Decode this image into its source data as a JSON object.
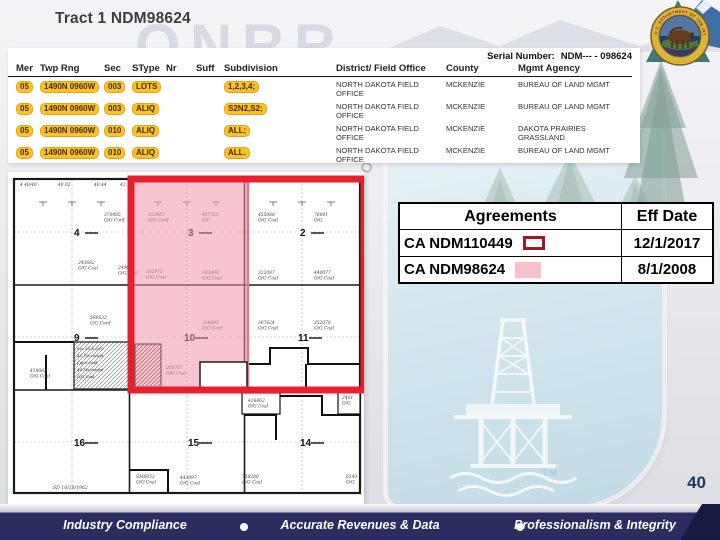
{
  "title": "Tract 1 NDM98624",
  "page_number": "40",
  "serial": {
    "label": "Serial Number:",
    "value": "NDM--- - 098624"
  },
  "lease_table": {
    "headers": [
      "Mer",
      "Twp Rng",
      "Sec",
      "SType",
      "Nr",
      "Suff",
      "Subdivision",
      "District/ Field Office",
      "County",
      "Mgmt Agency"
    ],
    "highlight_color": "#FFC125",
    "rows": [
      {
        "mer": "05",
        "twp_rng": "1490N 0960W",
        "sec": "003",
        "stype": "LOTS",
        "nr": "",
        "suff": "",
        "subdivision": "1,2,3,4;",
        "district": "NORTH DAKOTA FIELD OFFICE",
        "county": "MCKENZIE",
        "agency": "BUREAU OF LAND MGMT"
      },
      {
        "mer": "05",
        "twp_rng": "1490N 0960W",
        "sec": "003",
        "stype": "ALIQ",
        "nr": "",
        "suff": "",
        "subdivision": "S2N2,S2;",
        "district": "NORTH DAKOTA FIELD OFFICE",
        "county": "MCKENZIE",
        "agency": "BUREAU OF LAND MGMT"
      },
      {
        "mer": "05",
        "twp_rng": "1490N 0960W",
        "sec": "010",
        "stype": "ALIQ",
        "nr": "",
        "suff": "",
        "subdivision": "ALL;",
        "district": "NORTH DAKOTA FIELD OFFICE",
        "county": "MCKENZIE",
        "agency": "DAKOTA PRAIRIES GRASSLAND"
      },
      {
        "mer": "05",
        "twp_rng": "1490N 0960W",
        "sec": "010",
        "stype": "ALIQ",
        "nr": "",
        "suff": "",
        "subdivision": "ALL.",
        "district": "NORTH DAKOTA FIELD OFFICE",
        "county": "MCKENZIE",
        "agency": "BUREAU OF LAND MGMT"
      }
    ]
  },
  "agreements_table": {
    "headers": [
      "Agreements",
      "Eff Date"
    ],
    "rows": [
      {
        "agreement": "CA NDM110449",
        "eff_date": "12/1/2017",
        "swatch": "red-outline"
      },
      {
        "agreement": "CA NDM98624",
        "eff_date": "8/1/2008",
        "swatch": "pink-fill"
      }
    ],
    "swatch_colors": {
      "red_outline_border": "#9E1B25",
      "pink_fill": "#F8C0CD"
    }
  },
  "map": {
    "overlay_colors": {
      "red_outline": "#E8202C",
      "pink_fill": "rgba(240,150,172,0.55)",
      "pink_border": "#E0768F"
    },
    "section_numbers": [
      "4",
      "3",
      "2",
      "9",
      "10",
      "11",
      "16",
      "15",
      "14"
    ],
    "top_acreage_labels": [
      "4 40/40",
      "40.02",
      "40.44",
      "41.11"
    ],
    "lease_labels": [
      {
        "x": 96,
        "y": 44,
        "n": "370485",
        "c": "O/G Conf"
      },
      {
        "x": 70,
        "y": 92,
        "n": "243682",
        "c": "O/G Coal"
      },
      {
        "x": 110,
        "y": 97,
        "n": "249072",
        "c": "O/G Coal"
      },
      {
        "x": 82,
        "y": 147,
        "n": "599532",
        "c": "O/G Conf"
      },
      {
        "x": 140,
        "y": 44,
        "n": "153957",
        "c": "O/G Conf"
      },
      {
        "x": 194,
        "y": 44,
        "n": "457751",
        "c": "O/C"
      },
      {
        "x": 138,
        "y": 101,
        "n": "302975",
        "c": "O/G Coal"
      },
      {
        "x": 194,
        "y": 102,
        "n": "303480",
        "c": "O/G Coal"
      },
      {
        "x": 250,
        "y": 44,
        "n": "455088",
        "c": "O/G Coal"
      },
      {
        "x": 306,
        "y": 44,
        "n": "76041",
        "c": "O/G"
      },
      {
        "x": 250,
        "y": 102,
        "n": "322087",
        "c": "O/G Coal"
      },
      {
        "x": 306,
        "y": 102,
        "n": "440077",
        "c": "O/G Coal"
      },
      {
        "x": 194,
        "y": 152,
        "n": "330495",
        "c": "O/G Conf"
      },
      {
        "x": 250,
        "y": 152,
        "n": "307624",
        "c": "O/G Coal"
      },
      {
        "x": 306,
        "y": 152,
        "n": "352078",
        "c": "O/G Coal"
      },
      {
        "x": 158,
        "y": 197,
        "n": "200787",
        "c": "O/G Coal"
      },
      {
        "x": 240,
        "y": 230,
        "n": "416462",
        "c": "O/G Coal"
      },
      {
        "x": 334,
        "y": 227,
        "n": "2401",
        "c": "O/G"
      },
      {
        "x": 22,
        "y": 200,
        "n": "419062",
        "c": "O/G Coal"
      },
      {
        "x": 128,
        "y": 306,
        "n": "SM6053",
        "c": "O/G Coal"
      },
      {
        "x": 172,
        "y": 307,
        "n": "443097",
        "c": "O/G Coal"
      },
      {
        "x": 234,
        "y": 306,
        "n": "756280",
        "c": "O/G Coal"
      },
      {
        "x": 338,
        "y": 306,
        "n": "6540",
        "c": "O/G"
      }
    ],
    "note_box_lines": [
      "Sec 30 X 2/12",
      "AC l'ts except",
      "Cap't Coal",
      "AS l'ts except",
      "O/G Coal"
    ],
    "bottom_date_label": "SD 10/18/1962"
  },
  "footer": {
    "items": [
      "Industry Compliance",
      "Accurate Revenues & Data",
      "Professionalism & Integrity"
    ]
  },
  "watermark": {
    "onrr": "ONRR",
    "arc_text": "ATURAL RESOURC",
    "tm": "TM"
  },
  "logo": {
    "ring_text_top": "U.S. DEPARTMENT OF THE INTERIOR",
    "ring_text_bottom": "MARCH 3, 1849"
  }
}
